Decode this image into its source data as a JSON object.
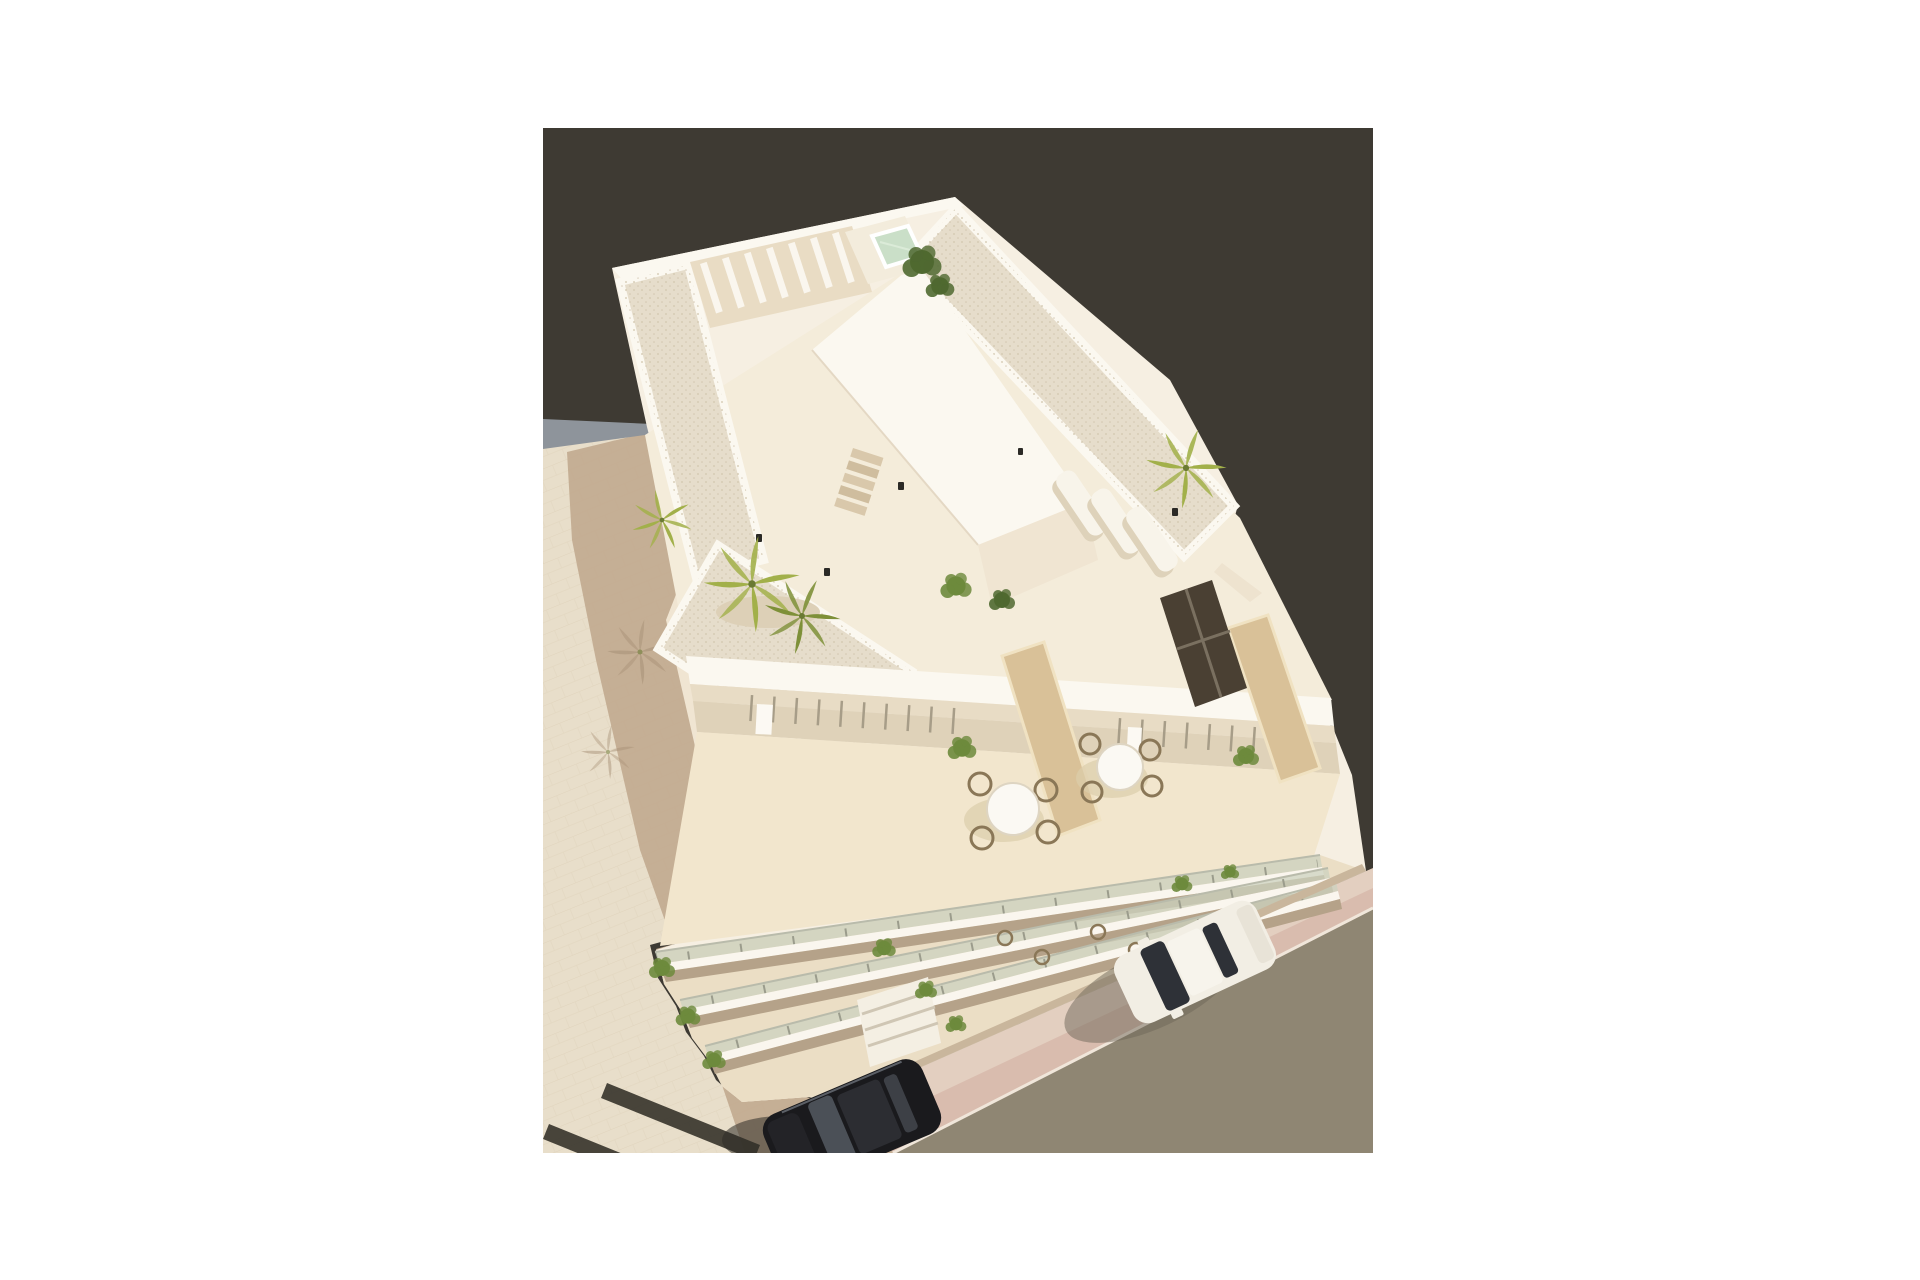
{
  "scene": {
    "type": "3d-architectural-rendering",
    "caption": "Aerial 3D architectural rendering of a white modern apartment building with rooftop terraces, a small pool, pergola, palm trees, balconies with glass railings, a paved plaza with the building shadow, and a street with a white car and a black car",
    "elements": [
      "apartment building",
      "rooftop gravel terraces",
      "rooftop pool",
      "pergola slats",
      "stair core",
      "palm trees",
      "shrubs",
      "sun loungers",
      "terrace dining tables and chairs",
      "privacy partitions",
      "dark glazed door",
      "balconies with glass railings and plants",
      "paved plaza",
      "building shadow",
      "gray boundary wall",
      "pink sidewalk",
      "asphalt road",
      "white car",
      "black car",
      "dark pavement stripes",
      "light pavement slats"
    ]
  },
  "palette": {
    "backdrop": "#3e3a33",
    "plaza": "#e8deca",
    "plaza_shadow": "#c3ac91",
    "curb": "#8e949b",
    "road": "#8f8673",
    "sidewalk": "#e3cfc0",
    "sidewalk_pink": "#d9bcae",
    "building": "#f6efe2",
    "building_bright": "#fbf8f0",
    "building_shade": "#f0e5d2",
    "facade": "#ebdec5",
    "terrace": "#f4ecda",
    "dining_floor": "#f2e6cd",
    "recess": "#dfd2b9",
    "gravel": "#e6ddcb",
    "pool": "#cadfc8",
    "glass": "#ccd2bf",
    "partition": "#d9c198",
    "door": "#4a4033",
    "palm": "#a2b04a",
    "palm_dark": "#7e9038",
    "tree": "#4f6930",
    "shrub": "#6d8a3c",
    "shadow_tint": "#aa9379",
    "table": "#fbf9f3",
    "chair": "#8a7757",
    "lounger": "#f8f4ea",
    "step_tan": "#d9c8ab",
    "car_white": "#f2eee4",
    "car_glass": "#2e3137",
    "car_dark": "#1a1a1d",
    "car_dark_roof": "#2c2d32",
    "car_highlight": "#555a62",
    "stripe_dark": "#39362e",
    "stripe_light": "#f3ecd9"
  }
}
